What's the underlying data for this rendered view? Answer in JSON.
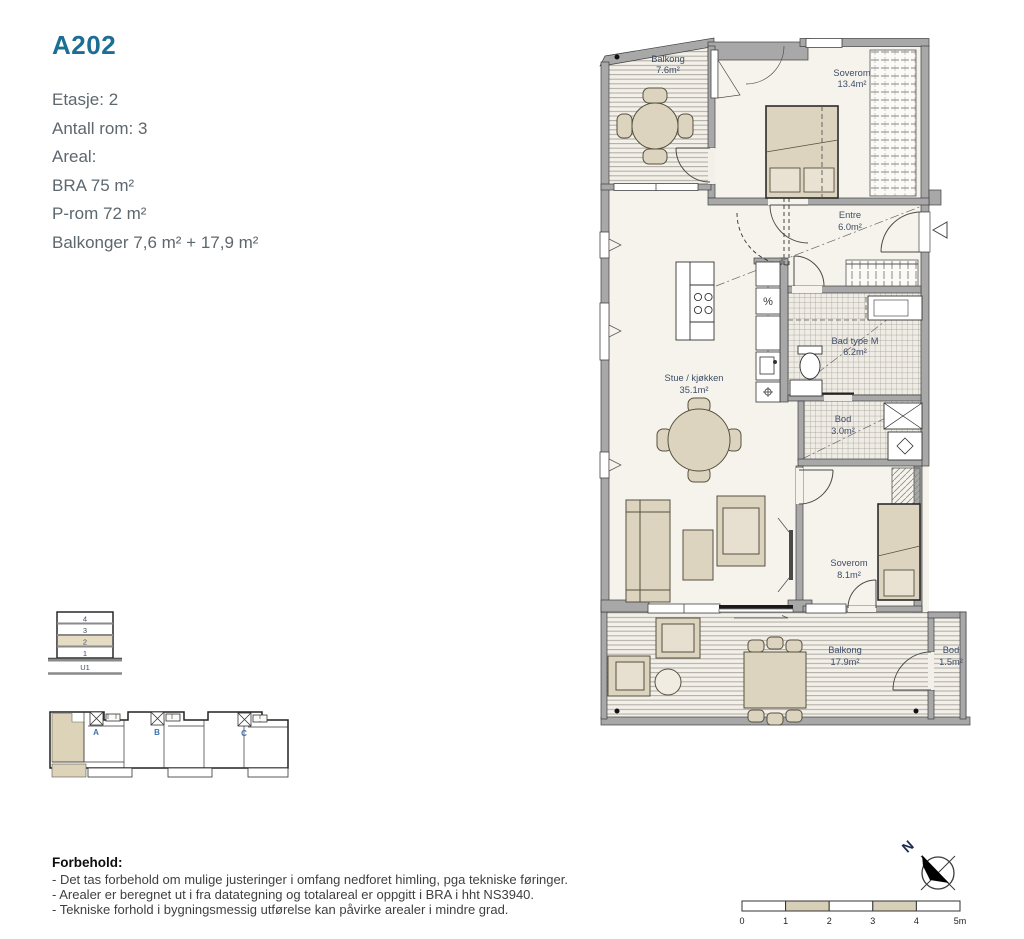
{
  "header": {
    "title": "A202"
  },
  "info": {
    "lines": [
      "Etasje: 2",
      "Antall rom: 3",
      "Areal:",
      "BRA 75 m²",
      "P-rom 72 m²",
      "Balkonger 7,6 m² + 17,9 m²"
    ]
  },
  "plan": {
    "rooms": {
      "balkong_nord": {
        "name": "Balkong",
        "area": "7.6m²"
      },
      "soverom_stor": {
        "name": "Soverom",
        "area": "13.4m²"
      },
      "entre": {
        "name": "Entre",
        "area": "6.0m²"
      },
      "stue_kjokken": {
        "name": "Stue / kjøkken",
        "area": "35.1m²"
      },
      "bad": {
        "name": "Bad type M",
        "area": "6.2m²"
      },
      "bod": {
        "name": "Bod",
        "area": "3.0m²"
      },
      "soverom_liten": {
        "name": "Soverom",
        "area": "8.1m²"
      },
      "balkong_sor": {
        "name": "Balkong",
        "area": "17.9m²"
      },
      "bod_balkong": {
        "name": "Bod",
        "area": "1.5m²"
      }
    },
    "symbols": {
      "dishwasher": "%"
    }
  },
  "floor_indicator": {
    "floors": [
      "4",
      "3",
      "2",
      "1"
    ],
    "basement": "U1",
    "highlighted_floor": "2"
  },
  "key_plan": {
    "stair_labels": [
      "A",
      "B",
      "C"
    ]
  },
  "compass": {
    "north_label": "N"
  },
  "scale_bar": {
    "ticks": [
      "0",
      "1",
      "2",
      "3",
      "4",
      "5m"
    ]
  },
  "disclaimer": {
    "heading": "Forbehold:",
    "lines": [
      "- Det tas forbehold om mulige justeringer i omfang nedforet himling, pga tekniske føringer.",
      "- Arealer er beregnet ut i fra datategning og totalareal er oppgitt i BRA i hht NS3940.",
      "- Tekniske forhold i bygningsmessig utførelse kan påvirke arealer i mindre grad."
    ]
  },
  "colors": {
    "title_accent": "#1b6f94",
    "room_label": "#3e4d68",
    "wall": "#a8a8a8",
    "furniture": "#ddd4c0",
    "floor": "#f6f3ec",
    "highlight": "#ddd3b8"
  }
}
